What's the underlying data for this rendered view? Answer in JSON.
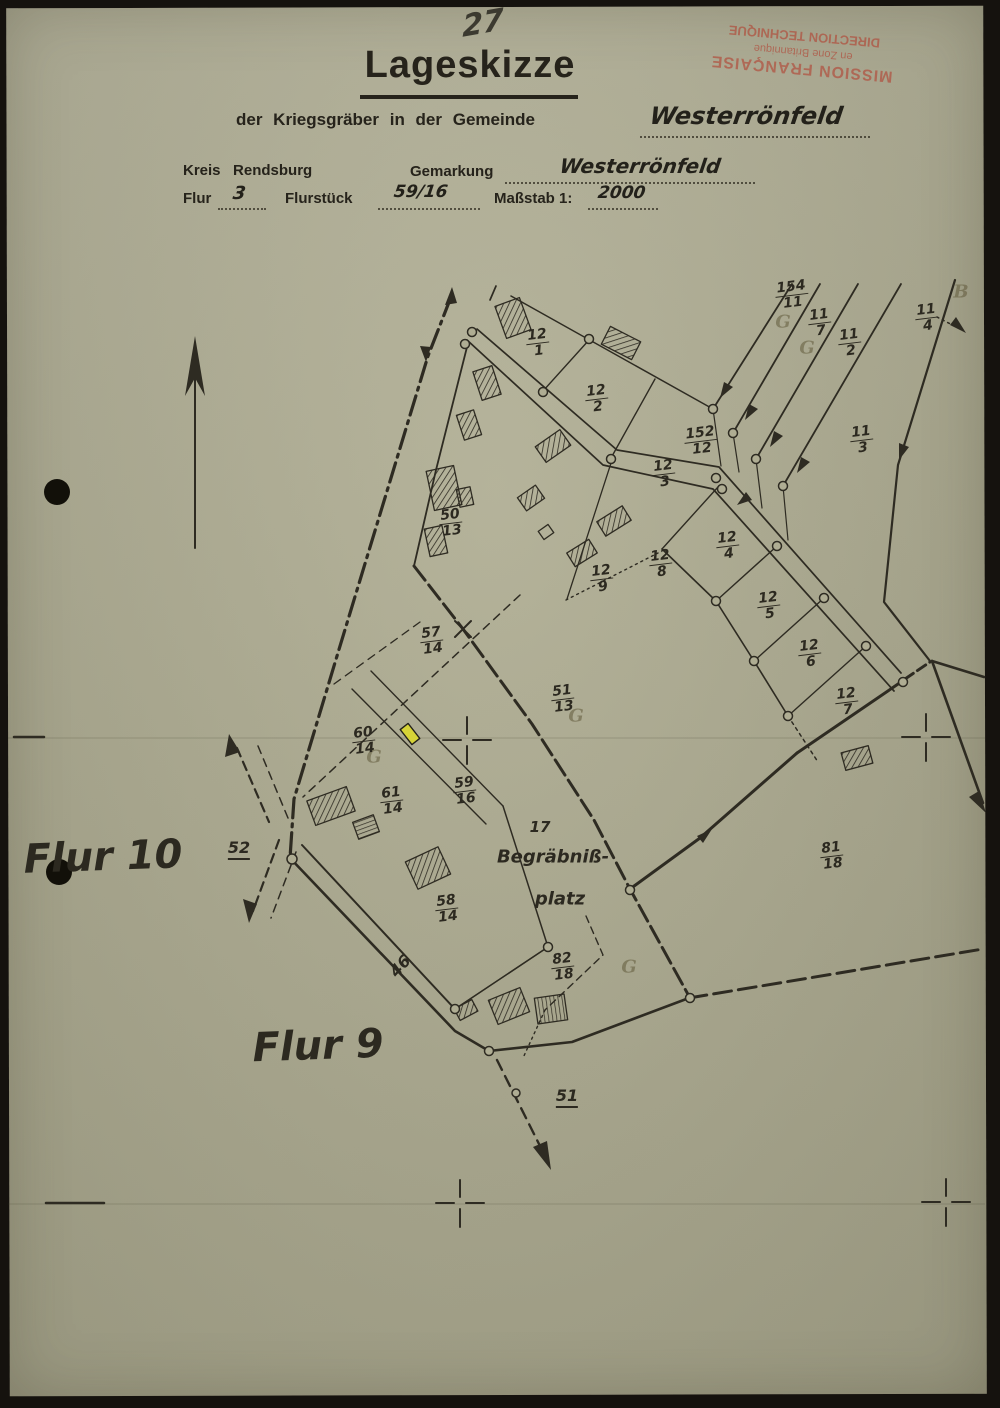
{
  "annotations": {
    "page_number": "27"
  },
  "stamp": {
    "line1": "MISSION FRANÇAISE",
    "line2": "en Zone Britannique",
    "line3": "DIRECTION TECHNIQUE",
    "color": "#b24232"
  },
  "header": {
    "title": "Lageskizze",
    "subtitle": "der Kriegsgräber in der Gemeinde",
    "gemeinde_value": "Westerrönfeld",
    "kreis_label": "Kreis",
    "kreis_value": "Rendsburg",
    "gemarkung_label": "Gemarkung",
    "gemarkung_value": "Westerrönfeld",
    "flur_label": "Flur",
    "flur_value": "3",
    "flurstueck_label": "Flurstück",
    "flurstueck_value": "59/16",
    "massstab_label": "Maßstab 1:",
    "massstab_value": "2000"
  },
  "map": {
    "highlight_color": "#d6d337",
    "parcels": [
      {
        "n": "12",
        "d": "1",
        "x": 538,
        "y": 343
      },
      {
        "n": "12",
        "d": "2",
        "x": 597,
        "y": 399
      },
      {
        "n": "152",
        "d": "12",
        "x": 701,
        "y": 441
      },
      {
        "n": "12",
        "d": "3",
        "x": 664,
        "y": 474
      },
      {
        "n": "12",
        "d": "4",
        "x": 728,
        "y": 546
      },
      {
        "n": "12",
        "d": "8",
        "x": 661,
        "y": 564
      },
      {
        "n": "12",
        "d": "9",
        "x": 602,
        "y": 579
      },
      {
        "n": "12",
        "d": "5",
        "x": 769,
        "y": 606
      },
      {
        "n": "12",
        "d": "6",
        "x": 810,
        "y": 654
      },
      {
        "n": "12",
        "d": "7",
        "x": 847,
        "y": 702
      },
      {
        "n": "154",
        "d": "11",
        "x": 792,
        "y": 295
      },
      {
        "n": "11",
        "d": "7",
        "x": 820,
        "y": 323
      },
      {
        "n": "11",
        "d": "2",
        "x": 850,
        "y": 343
      },
      {
        "n": "11",
        "d": "4",
        "x": 927,
        "y": 318
      },
      {
        "n": "11",
        "d": "3",
        "x": 862,
        "y": 440
      },
      {
        "n": "50",
        "d": "13",
        "x": 451,
        "y": 523
      },
      {
        "n": "57",
        "d": "14",
        "x": 432,
        "y": 641
      },
      {
        "n": "51",
        "d": "13",
        "x": 563,
        "y": 699
      },
      {
        "n": "60",
        "d": "14",
        "x": 364,
        "y": 741
      },
      {
        "n": "61",
        "d": "14",
        "x": 392,
        "y": 801
      },
      {
        "n": "59",
        "d": "16",
        "x": 465,
        "y": 791
      },
      {
        "n": "58",
        "d": "14",
        "x": 447,
        "y": 909
      },
      {
        "n": "82",
        "d": "18",
        "x": 563,
        "y": 967
      },
      {
        "n": "81",
        "d": "18",
        "x": 832,
        "y": 856
      }
    ],
    "labels": [
      {
        "text": "Flur 10",
        "x": 103,
        "y": 857,
        "cls": "flur"
      },
      {
        "text": "Flur 9",
        "x": 318,
        "y": 1046,
        "cls": "flur"
      },
      {
        "text": "52",
        "x": 239,
        "y": 849,
        "cls": "road",
        "underline": true
      },
      {
        "text": "51",
        "x": 567,
        "y": 1097,
        "cls": "road",
        "underline": true
      },
      {
        "text": "46",
        "x": 400,
        "y": 966,
        "cls": "road",
        "rot": -48
      },
      {
        "text": "17",
        "x": 540,
        "y": 827,
        "cls": "cem-num"
      },
      {
        "text": "Begräbniß-",
        "x": 553,
        "y": 857,
        "cls": "cem"
      },
      {
        "text": "platz",
        "x": 560,
        "y": 899,
        "cls": "cem"
      },
      {
        "text": "G",
        "x": 783,
        "y": 322,
        "cls": "pencil"
      },
      {
        "text": "G",
        "x": 807,
        "y": 348,
        "cls": "pencil"
      },
      {
        "text": "G",
        "x": 576,
        "y": 716,
        "cls": "pencil"
      },
      {
        "text": "G",
        "x": 374,
        "y": 757,
        "cls": "pencil"
      },
      {
        "text": "G",
        "x": 629,
        "y": 967,
        "cls": "pencil"
      },
      {
        "text": "B",
        "x": 961,
        "y": 292,
        "cls": "pencil"
      }
    ]
  }
}
